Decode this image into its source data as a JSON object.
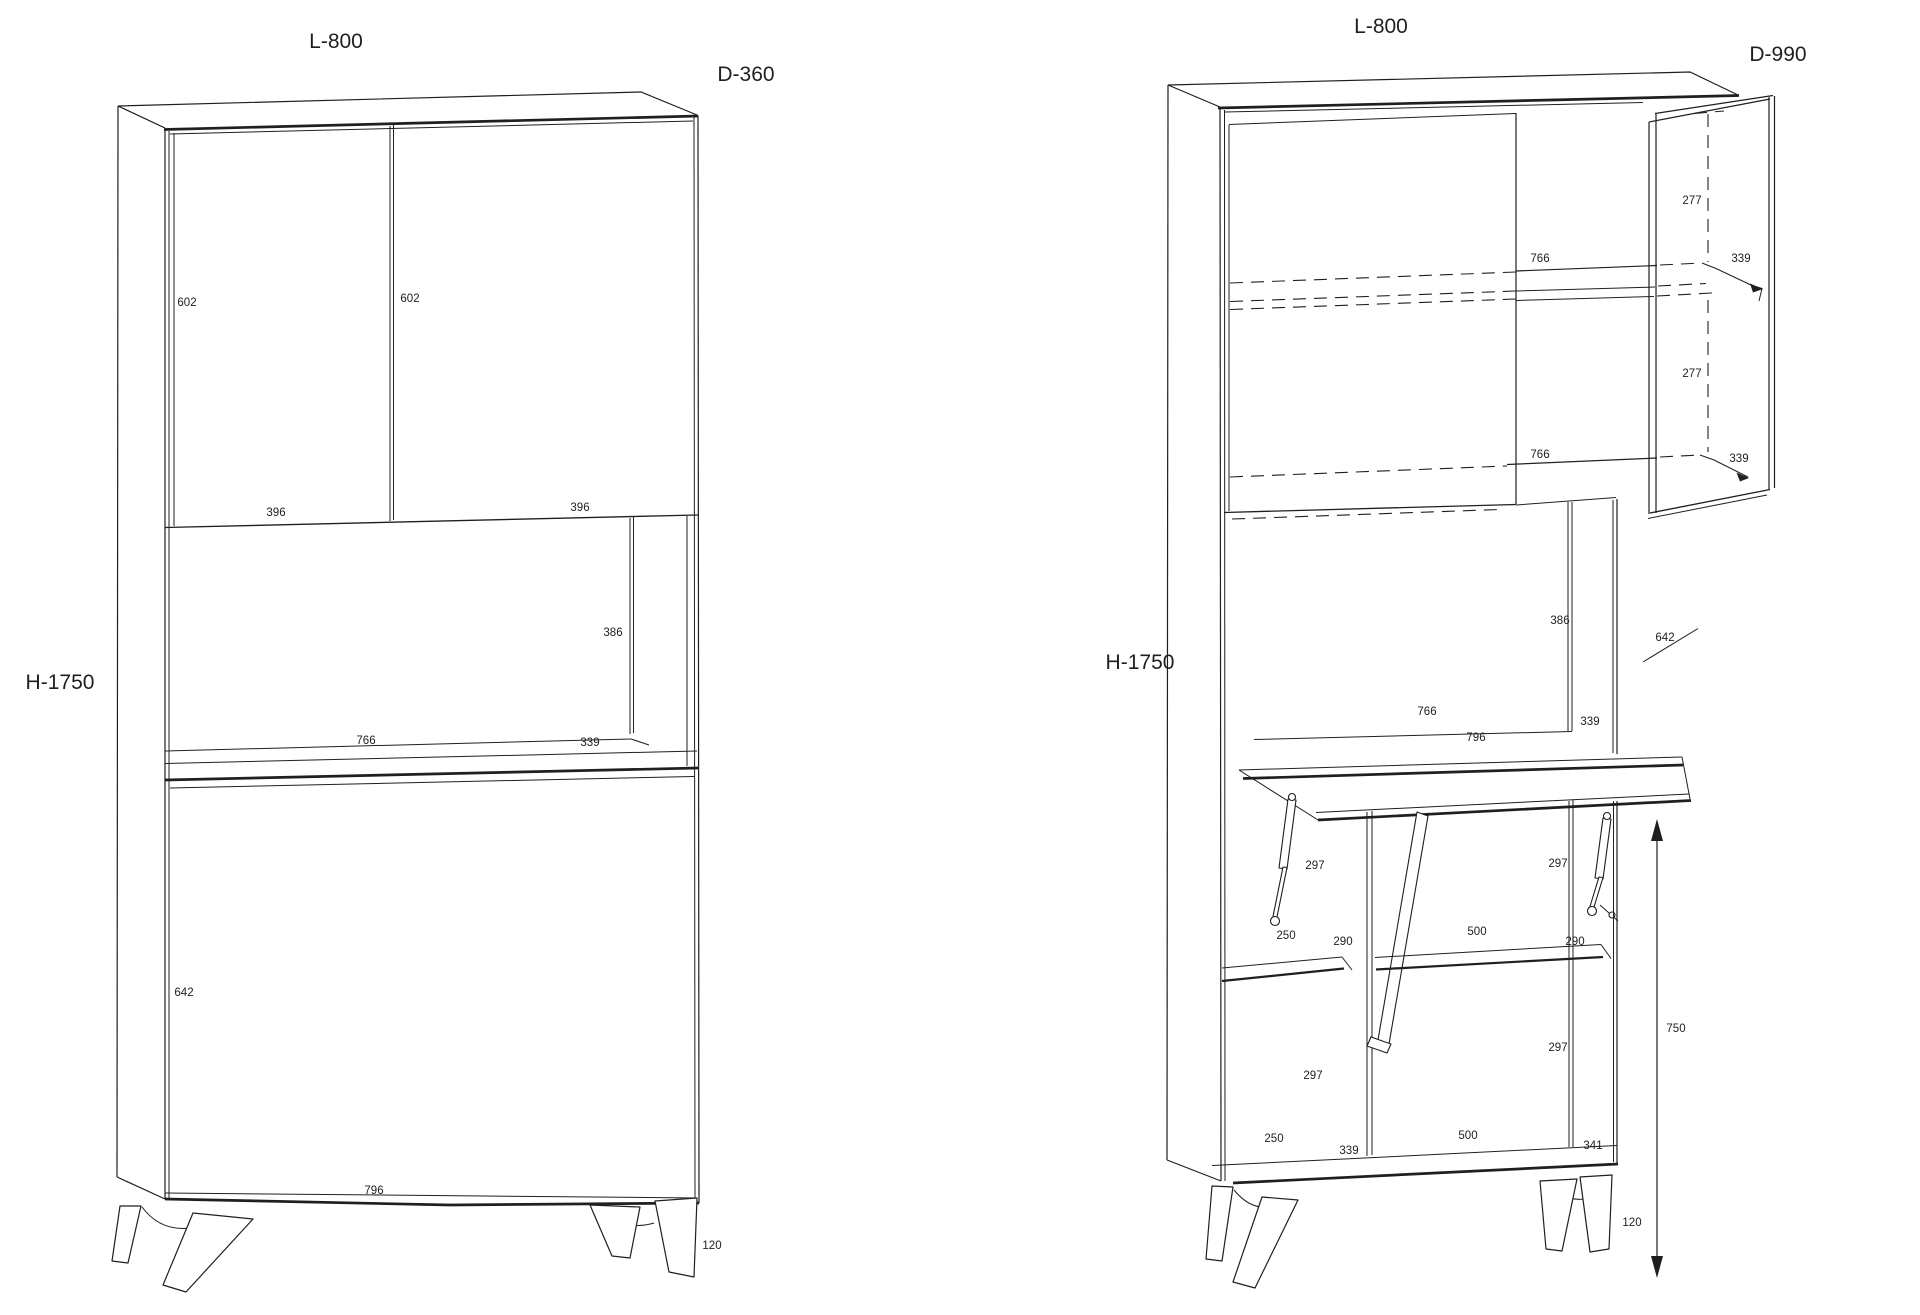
{
  "page": {
    "background": "#ffffff",
    "line_color": "#1f1f1f"
  },
  "left_view": {
    "title": "cabinet closed front view",
    "width_label": "L-800",
    "depth_label": "D-360",
    "height_label": "H-1750",
    "dims": {
      "door_left_height": "602",
      "door_right_height": "602",
      "door_left_width": "396",
      "door_right_width": "396",
      "niche_height": "386",
      "niche_width": "766",
      "niche_depth": "339",
      "lower_door_height": "642",
      "base_width": "796",
      "leg_height": "120"
    }
  },
  "right_view": {
    "title": "cabinet open view with desk",
    "width_label": "L-800",
    "depth_label": "D-990",
    "height_label": "H-1750",
    "dims": {
      "top_gap_height": "277",
      "top_shelf_width": "766",
      "top_shelf_depth": "339",
      "mid_gap_height": "277",
      "mid_shelf_width": "766",
      "mid_shelf_depth": "339",
      "niche_height": "386",
      "niche_width": "766",
      "niche_depth": "339",
      "desk_depth": "642",
      "desk_width": "796",
      "left_upper_height": "297",
      "right_upper_height": "297",
      "left_shelf_width": "250",
      "left_shelf_depth": "290",
      "right_shelf_width": "500",
      "right_shelf_depth": "290",
      "left_lower_height": "297",
      "right_lower_height": "297",
      "bottom_left_width": "250",
      "bottom_left_depth": "339",
      "bottom_right_width": "500",
      "bottom_right_depth": "341",
      "desk_height": "750",
      "leg_height": "120"
    }
  }
}
